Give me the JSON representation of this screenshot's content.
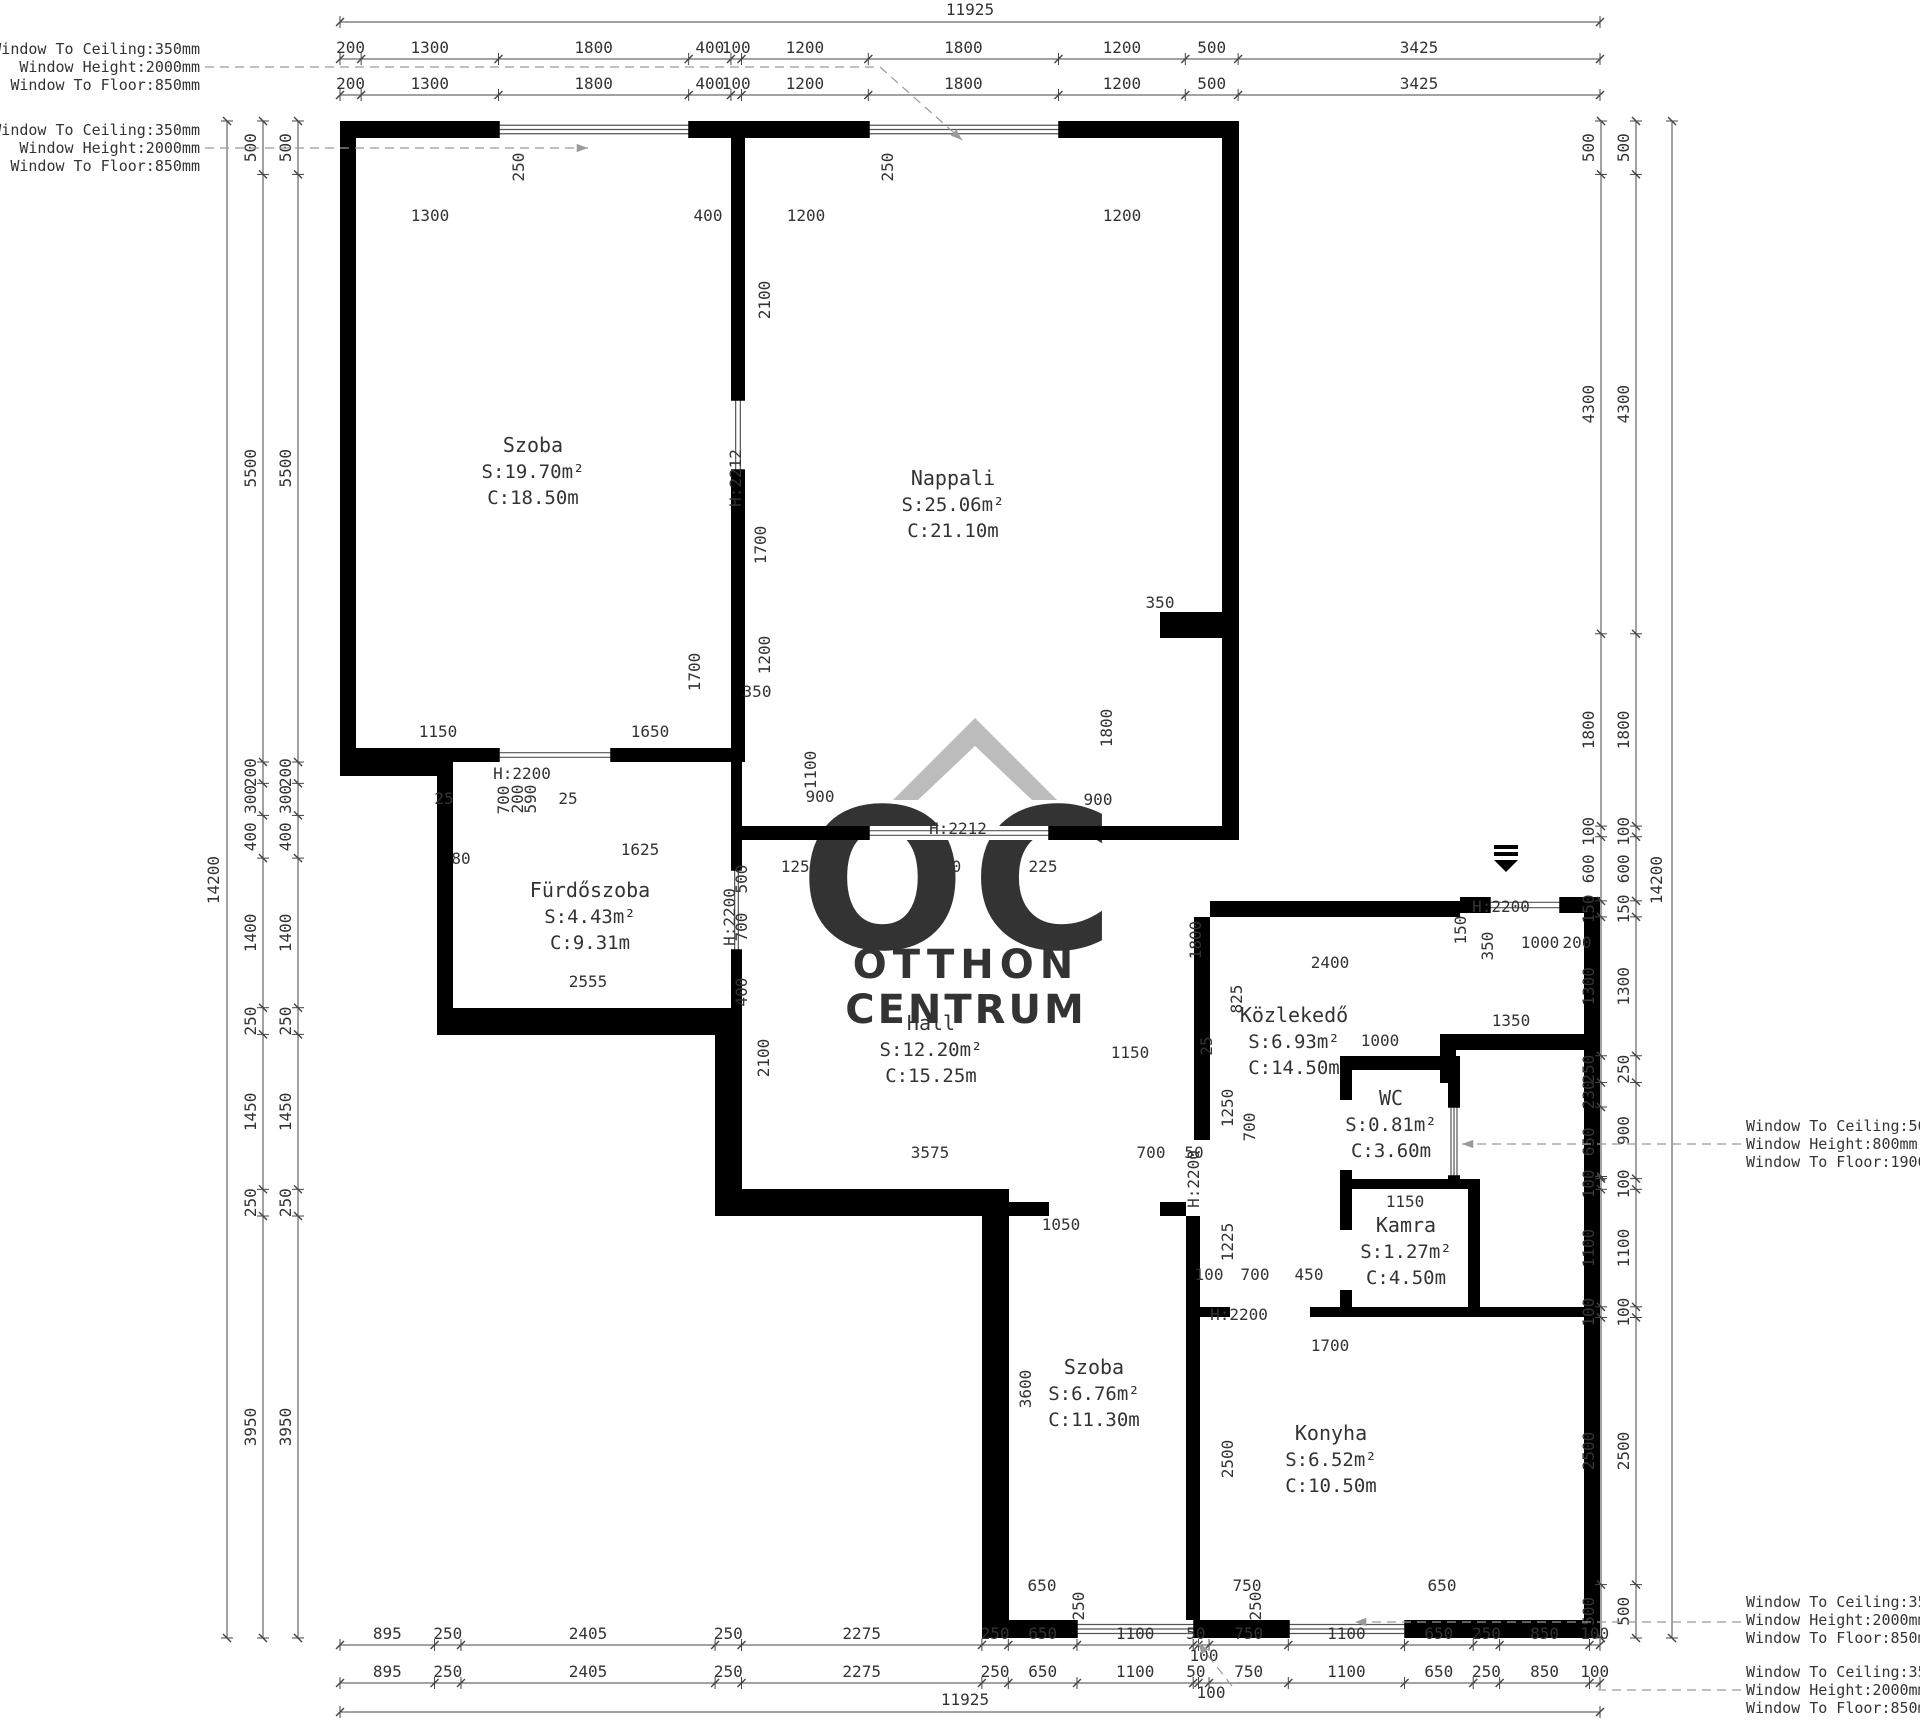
{
  "drawing": {
    "type": "apartment-floor-plan",
    "wall_color": "#000000",
    "dim_color": "#3a3a3a",
    "watermark_color": "#bcbcbc",
    "leader_color": "#9a9a9a"
  },
  "watermark": {
    "monogram": "OC",
    "line1": "OTTHON",
    "line2": "CENTRUM"
  },
  "rooms": [
    {
      "name": "Szoba",
      "s": "S:19.70m²",
      "c": "C:18.50m",
      "x": 533,
      "y": 452
    },
    {
      "name": "Nappali",
      "s": "S:25.06m²",
      "c": "C:21.10m",
      "x": 953,
      "y": 485
    },
    {
      "name": "Fürdőszoba",
      "s": "S:4.43m²",
      "c": "C:9.31m",
      "x": 590,
      "y": 897
    },
    {
      "name": "Hall",
      "s": "S:12.20m²",
      "c": "C:15.25m",
      "x": 931,
      "y": 1030
    },
    {
      "name": "Közlekedő",
      "s": "S:6.93m²",
      "c": "C:14.50m",
      "x": 1294,
      "y": 1022
    },
    {
      "name": "WC",
      "s": "S:0.81m²",
      "c": "C:3.60m",
      "x": 1391,
      "y": 1105
    },
    {
      "name": "Kamra",
      "s": "S:1.27m²",
      "c": "C:4.50m",
      "x": 1406,
      "y": 1232
    },
    {
      "name": "Szoba",
      "s": "S:6.76m²",
      "c": "C:11.30m",
      "x": 1094,
      "y": 1374
    },
    {
      "name": "Konyha",
      "s": "S:6.52m²",
      "c": "C:10.50m",
      "x": 1331,
      "y": 1440
    }
  ],
  "dimension_chains": {
    "top": {
      "segments": [
        200,
        1300,
        1800,
        400,
        100,
        1200,
        1800,
        1200,
        500,
        3425
      ],
      "total": "11925"
    },
    "bottom": {
      "segments": [
        895,
        250,
        2405,
        250,
        2275,
        250,
        650,
        1100,
        50,
        100,
        750,
        1100,
        650,
        250,
        850,
        100
      ],
      "total": "11925"
    },
    "left": {
      "segments": [
        500,
        5500,
        200,
        300,
        400,
        1400,
        250,
        1450,
        250,
        3950
      ],
      "total": "14200"
    },
    "right": {
      "inner": [
        500,
        4300,
        1800,
        100,
        600,
        150,
        1300,
        250,
        230,
        650,
        20,
        100,
        1100,
        100,
        2500,
        500
      ],
      "outer": [
        500,
        4300,
        1800,
        100,
        600,
        150,
        1300,
        250,
        900,
        100,
        1100,
        100,
        2500,
        500
      ],
      "total": "14200"
    }
  },
  "window_annotations": [
    {
      "side": "left",
      "x": 200,
      "y": 49,
      "leader": {
        "pts": [
          [
            205,
            67
          ],
          [
            880,
            67
          ],
          [
            962,
            140
          ]
        ],
        "arrow": true
      },
      "lines": [
        "Window To Ceiling:350mm",
        "Window Height:2000mm",
        "Window To Floor:850mm"
      ]
    },
    {
      "side": "left",
      "x": 200,
      "y": 130,
      "leader": {
        "pts": [
          [
            205,
            148
          ],
          [
            588,
            148
          ]
        ],
        "arrow": true
      },
      "lines": [
        "Window To Ceiling:350mm",
        "Window Height:2000mm",
        "Window To Floor:850mm"
      ]
    },
    {
      "side": "right",
      "x": 1746,
      "y": 1126,
      "leader": {
        "pts": [
          [
            1741,
            1144
          ],
          [
            1462,
            1144
          ]
        ],
        "arrow": true
      },
      "lines": [
        "Window To Ceiling:500mm",
        "Window Height:800mm",
        "Window To Floor:1900mm"
      ]
    },
    {
      "side": "right",
      "x": 1746,
      "y": 1602,
      "leader": {
        "pts": [
          [
            1741,
            1622
          ],
          [
            1355,
            1622
          ]
        ],
        "arrow": true
      },
      "lines": [
        "Window To Ceiling:350mm",
        "Window Height:2000mm",
        "Window To Floor:850mm"
      ]
    },
    {
      "side": "right",
      "x": 1746,
      "y": 1672,
      "leader": {
        "pts": [
          [
            1741,
            1690
          ],
          [
            1598,
            1690
          ]
        ],
        "arrow": false
      },
      "lines": [
        "Window To Ceiling:350mm",
        "Window Height:2000mm",
        "Window To Floor:850mm"
      ]
    }
  ],
  "extra_leaders": [
    {
      "pts": [
        [
          1232,
          1686
        ],
        [
          1198,
          1643
        ]
      ],
      "arrow": true
    }
  ],
  "interior_dimensions": [
    [
      "250",
      524,
      167,
      1
    ],
    [
      "250",
      893,
      167,
      1
    ],
    [
      "1300",
      430,
      221,
      0
    ],
    [
      "400",
      708,
      221,
      0
    ],
    [
      "1200",
      806,
      221,
      0
    ],
    [
      "1200",
      1122,
      221,
      0
    ],
    [
      "2100",
      770,
      300,
      1
    ],
    [
      "H:2212",
      741,
      478,
      1
    ],
    [
      "1700",
      766,
      545,
      1
    ],
    [
      "1200",
      770,
      655,
      1
    ],
    [
      "350",
      757,
      697,
      0
    ],
    [
      "1700",
      700,
      672,
      1
    ],
    [
      "1150",
      438,
      737,
      0
    ],
    [
      "1650",
      650,
      737,
      0
    ],
    [
      "350",
      1160,
      608,
      0
    ],
    [
      "1800",
      1112,
      728,
      1
    ],
    [
      "900",
      1098,
      805,
      0
    ],
    [
      "1100",
      816,
      770,
      1
    ],
    [
      "900",
      820,
      802,
      0
    ],
    [
      "H:2200",
      522,
      779,
      0
    ],
    [
      "25",
      444,
      804,
      0
    ],
    [
      "700",
      509,
      800,
      1
    ],
    [
      "200",
      523,
      799,
      1
    ],
    [
      "590",
      536,
      799,
      1
    ],
    [
      "25",
      568,
      804,
      0
    ],
    [
      "80",
      461,
      864,
      0
    ],
    [
      "1625",
      640,
      855,
      0
    ],
    [
      "2555",
      588,
      987,
      0
    ],
    [
      "500",
      747,
      879,
      1
    ],
    [
      "700",
      747,
      927,
      1
    ],
    [
      "400",
      747,
      992,
      1
    ],
    [
      "H:2200",
      735,
      917,
      1
    ],
    [
      "1250",
      800,
      872,
      0
    ],
    [
      "1700",
      942,
      872,
      0
    ],
    [
      "225",
      1043,
      872,
      0
    ],
    [
      "H:2212",
      958,
      834,
      0
    ],
    [
      "1800",
      1201,
      940,
      1
    ],
    [
      "2100",
      769,
      1058,
      1
    ],
    [
      "1150",
      1130,
      1058,
      0
    ],
    [
      "25",
      1212,
      1046,
      1
    ],
    [
      "3575",
      930,
      1158,
      0
    ],
    [
      "700",
      1151,
      1158,
      0
    ],
    [
      "50",
      1194,
      1158,
      0
    ],
    [
      "1250",
      1233,
      1108,
      1
    ],
    [
      "1225",
      1233,
      1242,
      1
    ],
    [
      "2400",
      1330,
      968,
      0
    ],
    [
      "825",
      1242,
      999,
      1
    ],
    [
      "1000",
      1380,
      1046,
      0
    ],
    [
      "1350",
      1511,
      1026,
      0
    ],
    [
      "H:2200",
      1501,
      912,
      0
    ],
    [
      "1000",
      1540,
      948,
      0
    ],
    [
      "150",
      1466,
      930,
      1
    ],
    [
      "350",
      1493,
      946,
      1
    ],
    [
      "200",
      1577,
      948,
      0
    ],
    [
      "700",
      1255,
      1127,
      1
    ],
    [
      "100",
      1209,
      1280,
      0
    ],
    [
      "700",
      1255,
      1280,
      0
    ],
    [
      "450",
      1309,
      1280,
      0
    ],
    [
      "H:2200",
      1199,
      1179,
      1
    ],
    [
      "1050",
      1061,
      1230,
      0
    ],
    [
      "1150",
      1405,
      1207,
      0
    ],
    [
      "H:2200",
      1239,
      1320,
      0
    ],
    [
      "1700",
      1330,
      1351,
      0
    ],
    [
      "3600",
      1031,
      1389,
      1
    ],
    [
      "2500",
      1233,
      1459,
      1
    ],
    [
      "650",
      1042,
      1591,
      0
    ],
    [
      "250",
      1084,
      1606,
      1
    ],
    [
      "750",
      1247,
      1591,
      0
    ],
    [
      "250",
      1261,
      1606,
      1
    ],
    [
      "650",
      1442,
      1591,
      0
    ],
    [
      "100",
      1204,
      1661,
      0
    ],
    [
      "100",
      1211,
      1698,
      0
    ]
  ],
  "geometry": {
    "walls": [
      [
        340,
        121,
        159,
        17
      ],
      [
        689,
        121,
        180,
        17
      ],
      [
        1059,
        121,
        180,
        17
      ],
      [
        340,
        121,
        16,
        641
      ],
      [
        340,
        748,
        159,
        14
      ],
      [
        611,
        748,
        131,
        14
      ],
      [
        340,
        762,
        113,
        14
      ],
      [
        437,
        776,
        16,
        259
      ],
      [
        437,
        1008,
        305,
        27
      ],
      [
        715,
        1035,
        27,
        181
      ],
      [
        731,
        138,
        14,
        262
      ],
      [
        731,
        470,
        14,
        292
      ],
      [
        731,
        762,
        11,
        108
      ],
      [
        731,
        950,
        11,
        58
      ],
      [
        1222,
        138,
        17,
        692
      ],
      [
        742,
        826,
        127,
        14
      ],
      [
        1049,
        826,
        190,
        14
      ],
      [
        1160,
        612,
        62,
        26
      ],
      [
        715,
        1189,
        294,
        27
      ],
      [
        1009,
        1202,
        40,
        14
      ],
      [
        1160,
        1202,
        26,
        14
      ],
      [
        982,
        1216,
        27,
        404
      ],
      [
        982,
        1620,
        95,
        18
      ],
      [
        1194,
        1620,
        95,
        18
      ],
      [
        1405,
        1620,
        195,
        18
      ],
      [
        1186,
        1216,
        14,
        404
      ],
      [
        1194,
        917,
        16,
        223
      ],
      [
        1210,
        901,
        250,
        16
      ],
      [
        1460,
        897,
        30,
        16
      ],
      [
        1560,
        897,
        40,
        16
      ],
      [
        1584,
        897,
        16,
        741
      ],
      [
        1440,
        1034,
        144,
        16
      ],
      [
        1440,
        1034,
        16,
        49
      ],
      [
        1340,
        1056,
        120,
        14
      ],
      [
        1340,
        1056,
        12,
        44
      ],
      [
        1340,
        1170,
        12,
        19
      ],
      [
        1448,
        1056,
        12,
        51
      ],
      [
        1448,
        1176,
        12,
        13
      ],
      [
        1340,
        1179,
        140,
        10
      ],
      [
        1340,
        1189,
        12,
        41
      ],
      [
        1340,
        1290,
        12,
        27
      ],
      [
        1468,
        1189,
        12,
        128
      ],
      [
        1186,
        1307,
        44,
        10
      ],
      [
        1310,
        1307,
        290,
        10
      ]
    ],
    "openings": [
      [
        499,
        121,
        190,
        17,
        "h",
        3
      ],
      [
        869,
        121,
        190,
        17,
        "h",
        3
      ],
      [
        499,
        748,
        112,
        14,
        "h",
        2
      ],
      [
        731,
        400,
        14,
        70,
        "v",
        2
      ],
      [
        731,
        870,
        11,
        80,
        "v",
        2
      ],
      [
        869,
        826,
        180,
        14,
        "h",
        2
      ],
      [
        1490,
        897,
        70,
        16,
        "h",
        2
      ],
      [
        1448,
        1107,
        12,
        69,
        "v",
        3
      ],
      [
        1077,
        1620,
        117,
        18,
        "h",
        3
      ],
      [
        1289,
        1620,
        116,
        18,
        "h",
        3
      ]
    ],
    "entrance_arrow": {
      "x": 1506,
      "y": 845
    }
  }
}
